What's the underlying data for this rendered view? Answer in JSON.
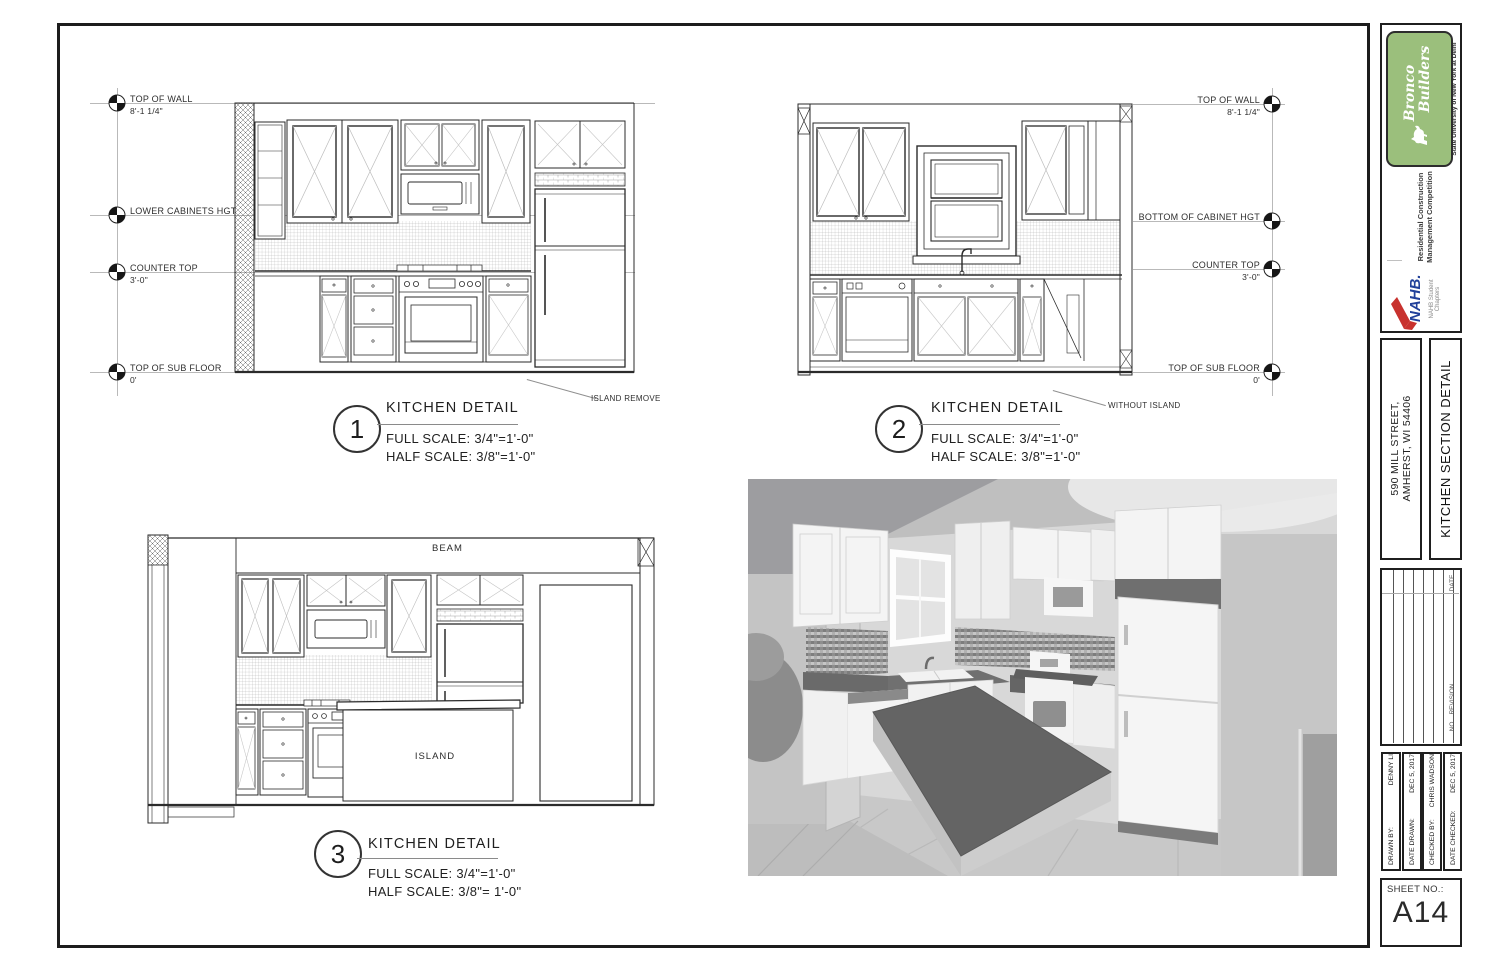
{
  "details": [
    {
      "number": "1",
      "title": "KITCHEN DETAIL",
      "full_scale": "FULL SCALE: 3/4\"=1'-0\"",
      "half_scale": "HALF SCALE: 3/8\"=1'-0\"",
      "annotation": "ISLAND REMOVE"
    },
    {
      "number": "2",
      "title": "KITCHEN DETAIL",
      "full_scale": "FULL SCALE: 3/4\"=1'-0\"",
      "half_scale": "HALF SCALE: 3/8\"=1'-0\"",
      "annotation": "WITHOUT ISLAND"
    },
    {
      "number": "3",
      "title": "KITCHEN DETAIL",
      "full_scale": "FULL SCALE: 3/4\"=1'-0\"",
      "half_scale": "HALF SCALE: 3/8\"= 1'-0\"",
      "annotations": {
        "beam": "BEAM",
        "island": "ISLAND"
      }
    }
  ],
  "datum_left": [
    {
      "label": "TOP OF WALL",
      "value": "8'-1 1/4\""
    },
    {
      "label": "LOWER CABINETS HGT",
      "value": ""
    },
    {
      "label": "COUNTER TOP",
      "value": "3'-0\""
    },
    {
      "label": "TOP OF SUB FLOOR",
      "value": "0'"
    }
  ],
  "datum_right": [
    {
      "label": "TOP OF WALL",
      "value": "8'-1 1/4\""
    },
    {
      "label": "BOTTOM OF CABINET HGT",
      "value": ""
    },
    {
      "label": "COUNTER TOP",
      "value": "3'-0\""
    },
    {
      "label": "TOP OF SUB FLOOR",
      "value": "0'"
    }
  ],
  "title_block": {
    "logo": {
      "company_line1": "Bronco",
      "company_line2": "Builders",
      "university": "State University of New York at Delhi",
      "competition_line1": "Residential Construction",
      "competition_line2": "Management Competition",
      "nahb": "NAHB.",
      "nahb_sub1": "NAHB Student",
      "nahb_sub2": "Chapters",
      "green": "#9bbf7c",
      "nahb_blue": "#21409a",
      "nahb_red": "#c8322e"
    },
    "address_line1": "590 MILL STREET,",
    "address_line2": "AMHERST, WI 54406",
    "sheet_title": "KITCHEN SECTION DETAIL",
    "revision_headers": {
      "date": "DATE",
      "revision": "REVISION",
      "no": "NO."
    },
    "credits": [
      {
        "label": "DRAWN BY:",
        "value": "DENNY LI"
      },
      {
        "label": "DATE DRAWN:",
        "value": "DEC 5, 2017"
      },
      {
        "label": "CHECKED BY:",
        "value": "CHRIS WADSON"
      },
      {
        "label": "DATE CHECKED:",
        "value": "DEC 5, 2017"
      }
    ],
    "sheet_no_label": "SHEET NO.:",
    "sheet_no": "A14"
  }
}
